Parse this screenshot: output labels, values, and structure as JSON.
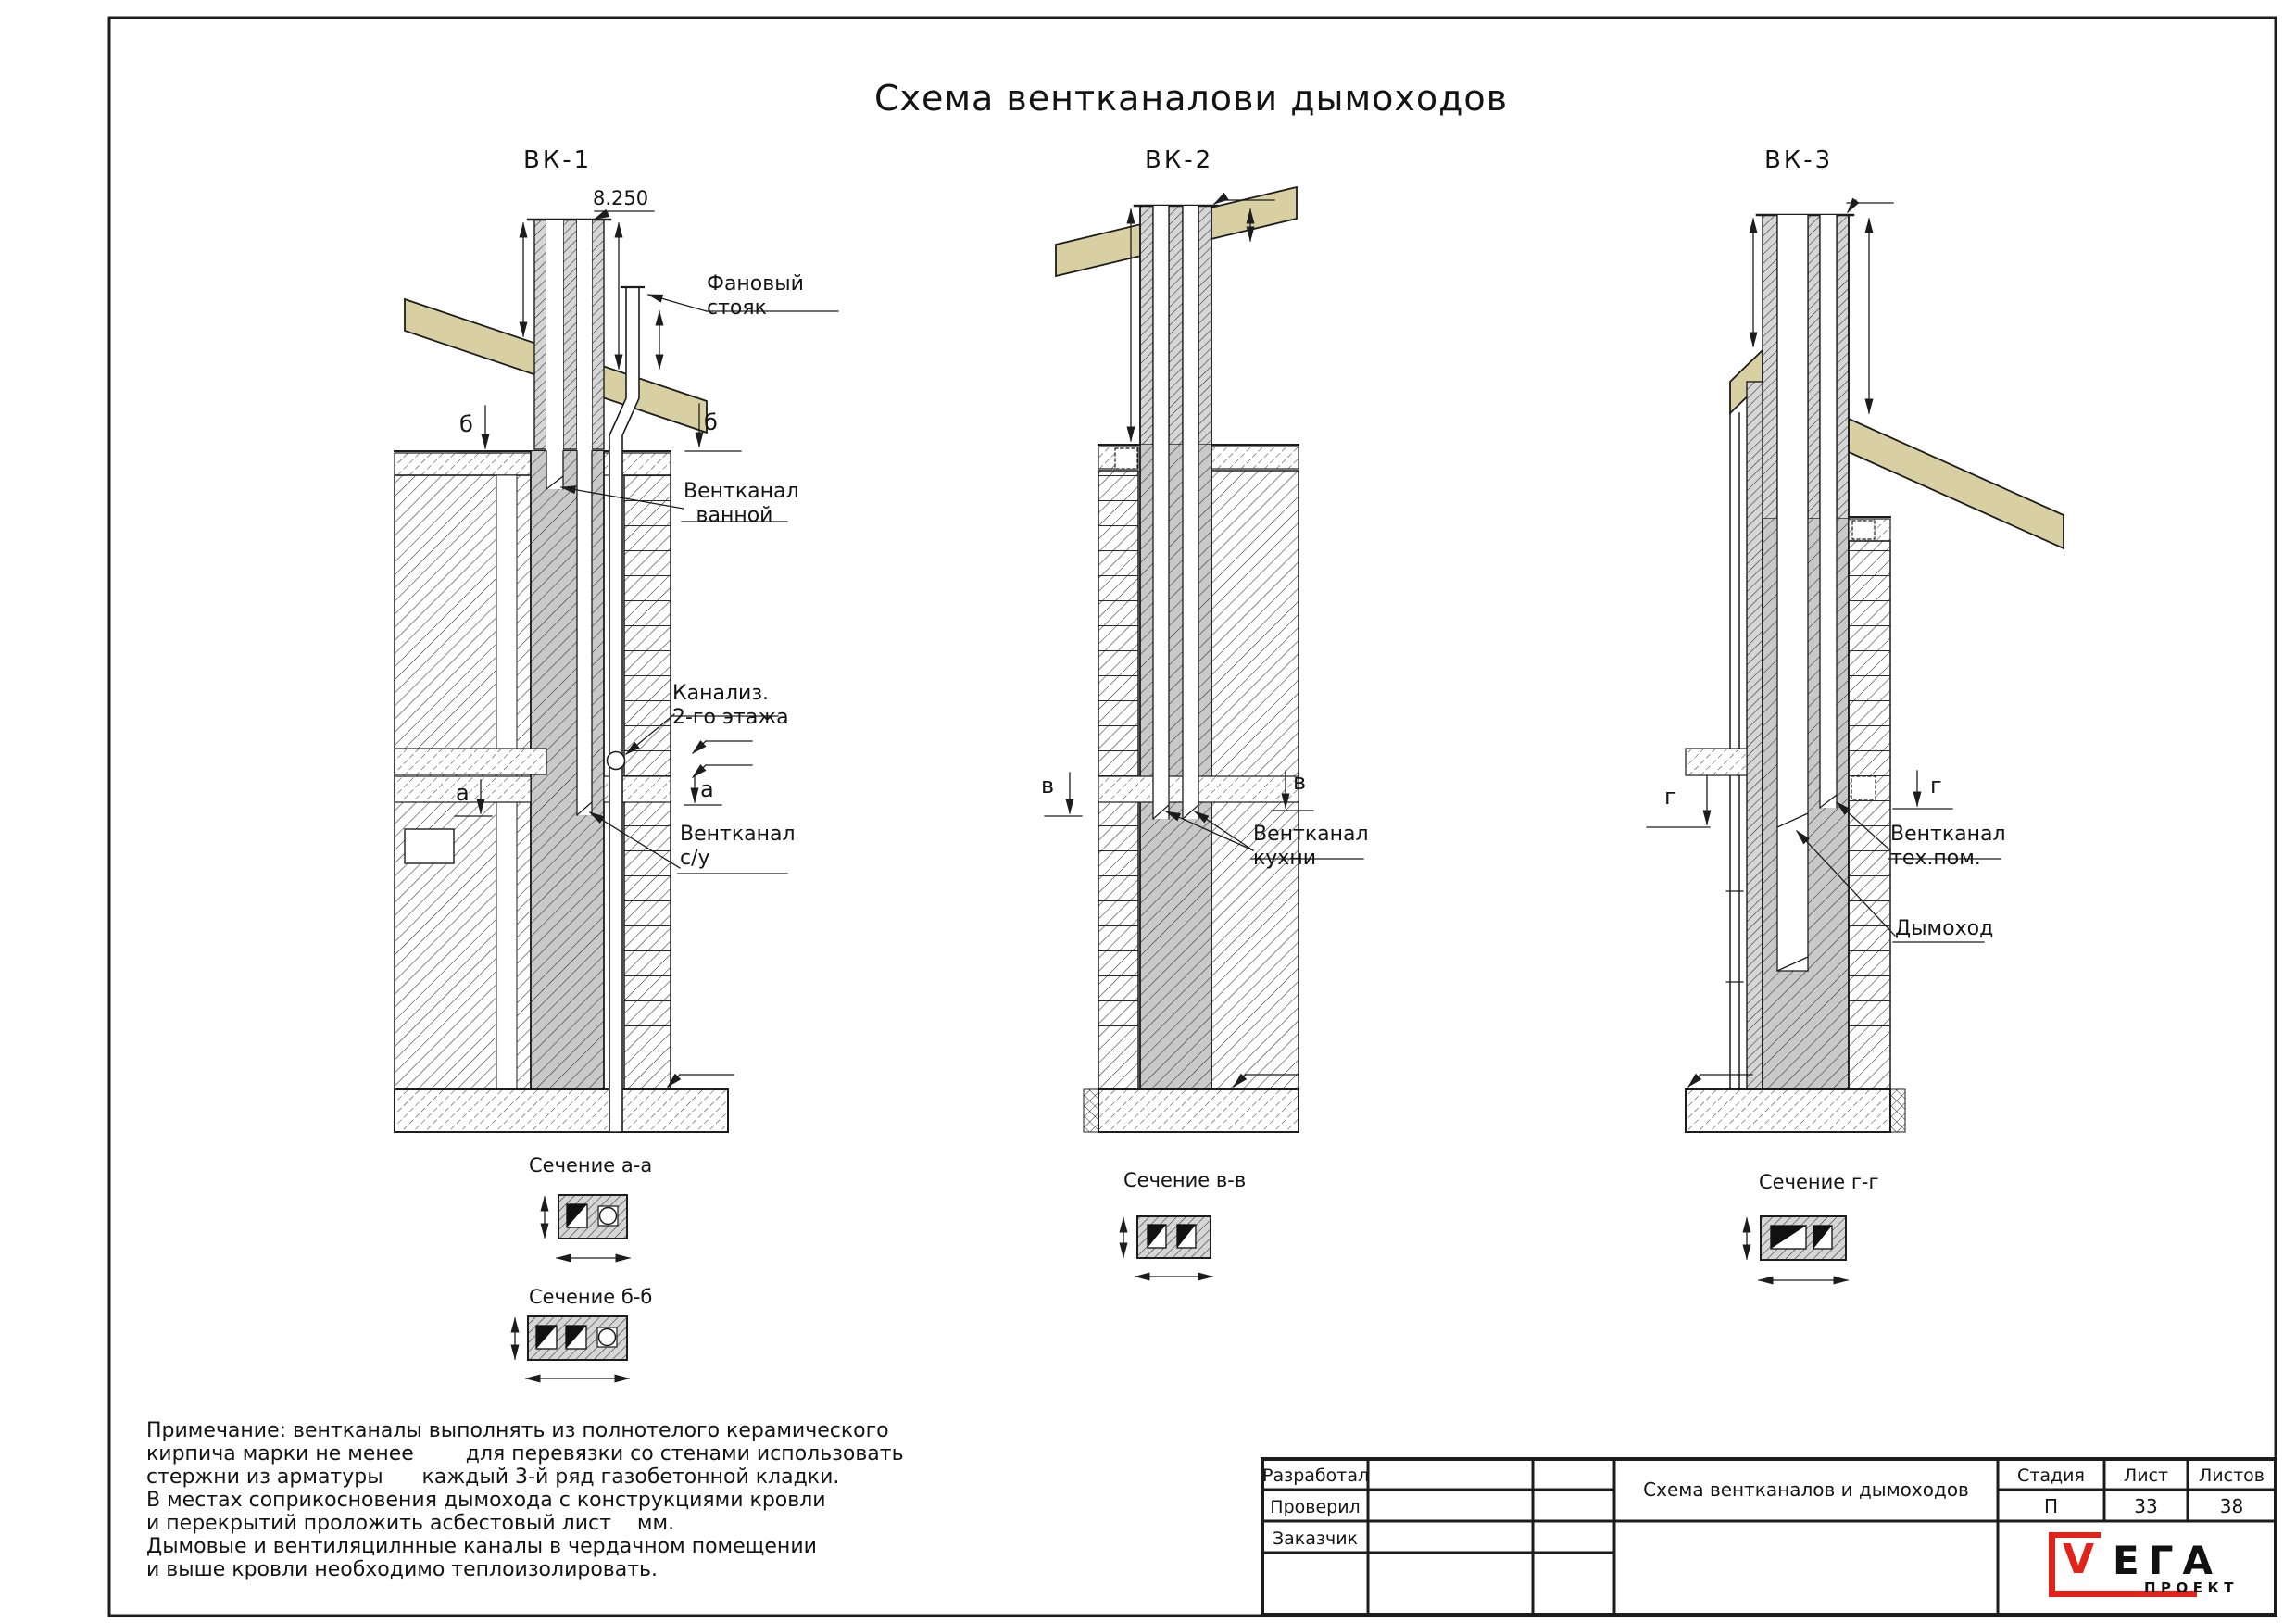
{
  "page": {
    "title": "Схема вентканалови дымоходов"
  },
  "drawings": [
    {
      "name": "ВК-1",
      "elevation": "8.250",
      "labels": {
        "stack": "Фановый\nстояк",
        "bath": "Вентканал\nванной",
        "sewer": "Канализ.\n2-го этажа",
        "wc": "Вентканал\nс/у"
      },
      "markers": {
        "b": "б",
        "a": "а"
      },
      "sections": [
        {
          "title": "Сечение а-а"
        },
        {
          "title": "Сечение б-б"
        }
      ]
    },
    {
      "name": "ВК-2",
      "labels": {
        "kitchen": "Вентканал\nкухни"
      },
      "markers": {
        "v": "в"
      },
      "sections": [
        {
          "title": "Сечение в-в"
        }
      ]
    },
    {
      "name": "ВК-3",
      "labels": {
        "tech": "Вентканал\nтех.пом.",
        "flue": "Дымоход"
      },
      "markers": {
        "g": "г"
      },
      "sections": [
        {
          "title": "Сечение г-г"
        }
      ]
    }
  ],
  "note": {
    "lines": [
      "Примечание: вентканалы выполнять из полнотелого керамического",
      "кирпича марки не менее        для перевязки со стенами использовать",
      "стержни из арматуры      каждый 3-й ряд газобетонной кладки.",
      "В местах соприкосновения дымохода с конструкциями кровли",
      "и перекрытий проложить асбестовый лист    мм.",
      "Дымовые и вентиляцилнные каналы в чердачном помещении",
      "и выше кровли необходимо теплоизолировать."
    ]
  },
  "title_block": {
    "rows": [
      {
        "label": "Разработал"
      },
      {
        "label": "Проверил"
      },
      {
        "label": "Заказчик"
      }
    ],
    "doc_title": "Схема вентканалов и дымоходов",
    "columns": {
      "stage_label": "Стадия",
      "sheet_label": "Лист",
      "total_label": "Листов",
      "stage": "П",
      "sheet": "33",
      "total": "38"
    },
    "logo": {
      "v": "V",
      "rest": "ЕГА",
      "sub": "ПРОЕКТ"
    }
  },
  "colors": {
    "line": "#1c1c1c",
    "roof": "#d8d0a2",
    "accent_red": "#e2231a"
  }
}
